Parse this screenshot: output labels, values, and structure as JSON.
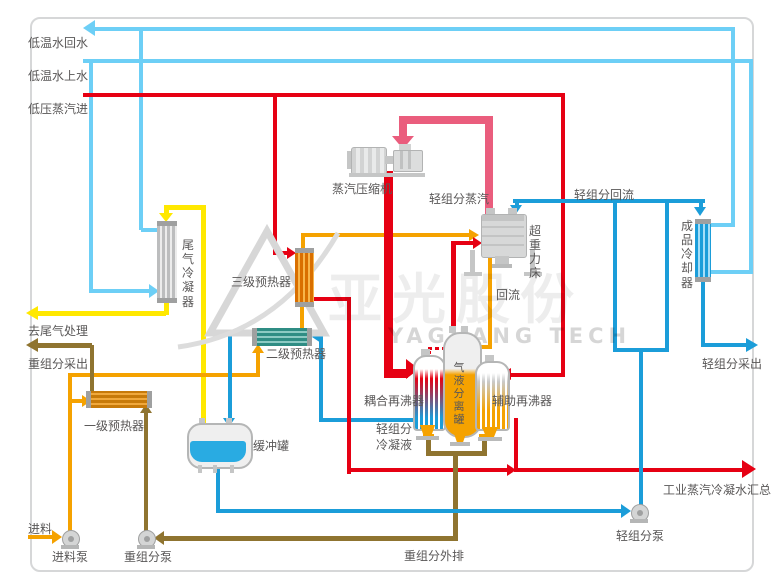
{
  "labels": {
    "cooling_return": "低温水回水",
    "cooling_supply": "低温水上水",
    "lp_steam_in": "低压蒸汽进",
    "tail_gas_condenser": "尾气冷凝器",
    "preheater3": "三级预热器",
    "preheater2": "二级预热器",
    "preheater1": "一级预热器",
    "compressor": "蒸汽压缩机",
    "light_vapor": "轻组分蒸汽",
    "rpb": "超重力床",
    "reflux": "回流",
    "light_reflux": "轻组分回流",
    "product_cooler": "成品冷却器",
    "light_draw": "轻组分采出",
    "coupled_reboiler": "耦合再沸器",
    "separator": "气液分离罐",
    "aux_reboiler": "辅助再沸器",
    "light_condensate": "轻组分冷凝液",
    "to_tail_gas": "去尾气处理",
    "heavy_draw": "重组分采出",
    "buffer_tank": "缓冲罐",
    "feed": "进料",
    "feed_pump": "进料泵",
    "heavy_pump": "重组分泵",
    "heavy_discharge": "重组分外排",
    "light_pump": "轻组分泵",
    "condensate_header": "工业蒸汽冷凝水汇总"
  },
  "watermark": {
    "cn": "亚光股份",
    "en": "YAGUANG TECH"
  },
  "colors": {
    "cooling_water": "#6dcff6",
    "steam": "#e60013",
    "compressed_vapor": "#ea5d7d",
    "feed": "#f5a200",
    "tail_gas": "#ffe800",
    "heavy_component": "#8f7430",
    "light_component": "#1b9dd9",
    "equipment_gray": "#c9caca"
  }
}
